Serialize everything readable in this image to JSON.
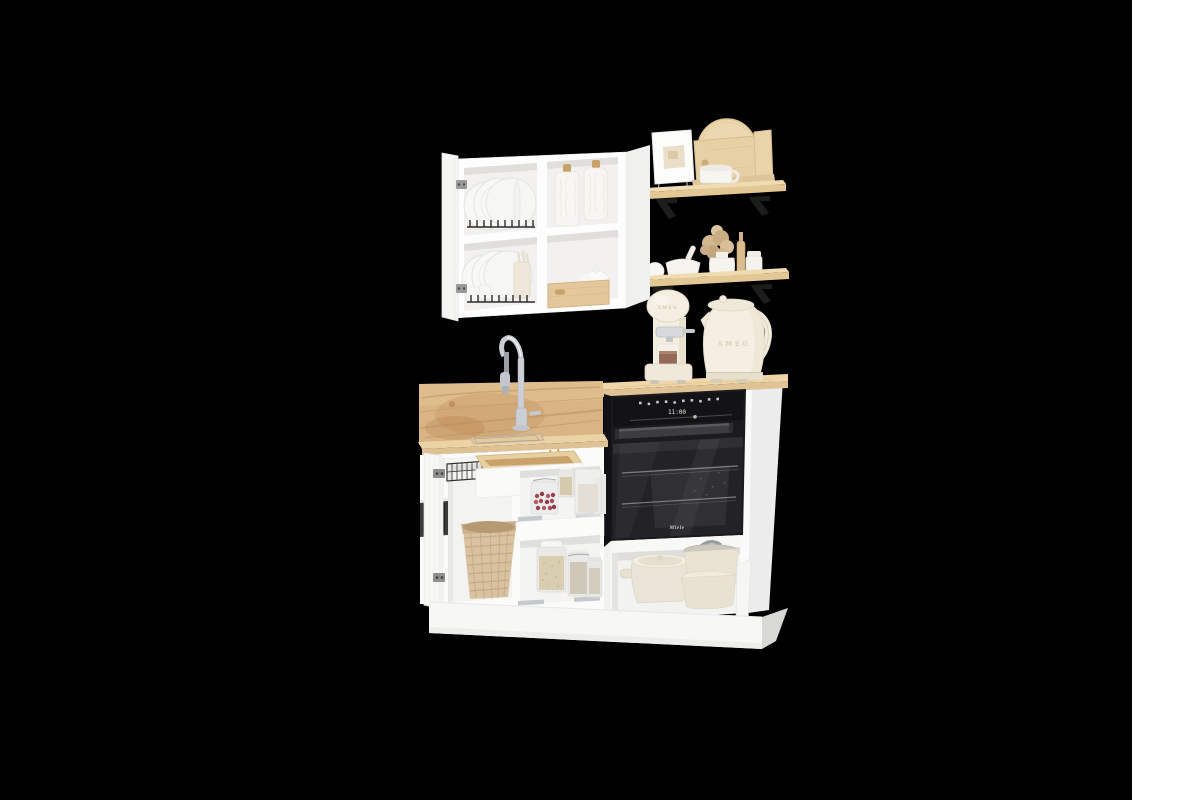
{
  "canvas": {
    "width": 1200,
    "height": 800,
    "background_color": "#000000",
    "right_panel_color": "#ffffff"
  },
  "scene": {
    "type": "3d-product-render",
    "subject": "Compact white modular kitchen set with oak countertop and backsplash, open wall cabinet with plate racks, wooden wall shelves, sink base unit with open storage, and tall oven housing with cream retro appliances"
  },
  "texts": {
    "coffee_machine_brand": "SMEG",
    "kettle_brand": "SMEG",
    "oven_clock": "11:00",
    "oven_brand": "Miele"
  },
  "colors": {
    "cabinet_white": "#fafafa",
    "interior_shadow": "#e0e0de",
    "oak_countertop": "#ecd3a6",
    "oak_backsplash": "#d9b586",
    "shelf_wood": "#ead5ab",
    "bracket_black": "#1d1d1b",
    "oven_black": "#1b1b1d",
    "oven_glass": "#232327",
    "appliance_cream": "#f4efe2",
    "steel_chrome": "#c9cdd3",
    "rattan_basket": "#d8c2a1",
    "berries_red": "#a54a56",
    "oats_tan": "#d9cdb2",
    "coffee_brown": "#7a4a33"
  },
  "objects": [
    "open wall cabinet with plate racks and ceramic canisters",
    "wooden wall shelf with framed card, cutting boards and mug",
    "wooden wall shelf with mortar, dried flowers, vases and bottle",
    "cream espresso machine",
    "cream electric kettle",
    "oak backsplash with chrome pull-down faucet and inset sink",
    "built-in black oven with touch control panel",
    "open base cabinet with glass food jars",
    "open drawer with wooden utensil tray",
    "rattan waste basket",
    "cream cookware pots in open compartment",
    "white plinth base"
  ]
}
